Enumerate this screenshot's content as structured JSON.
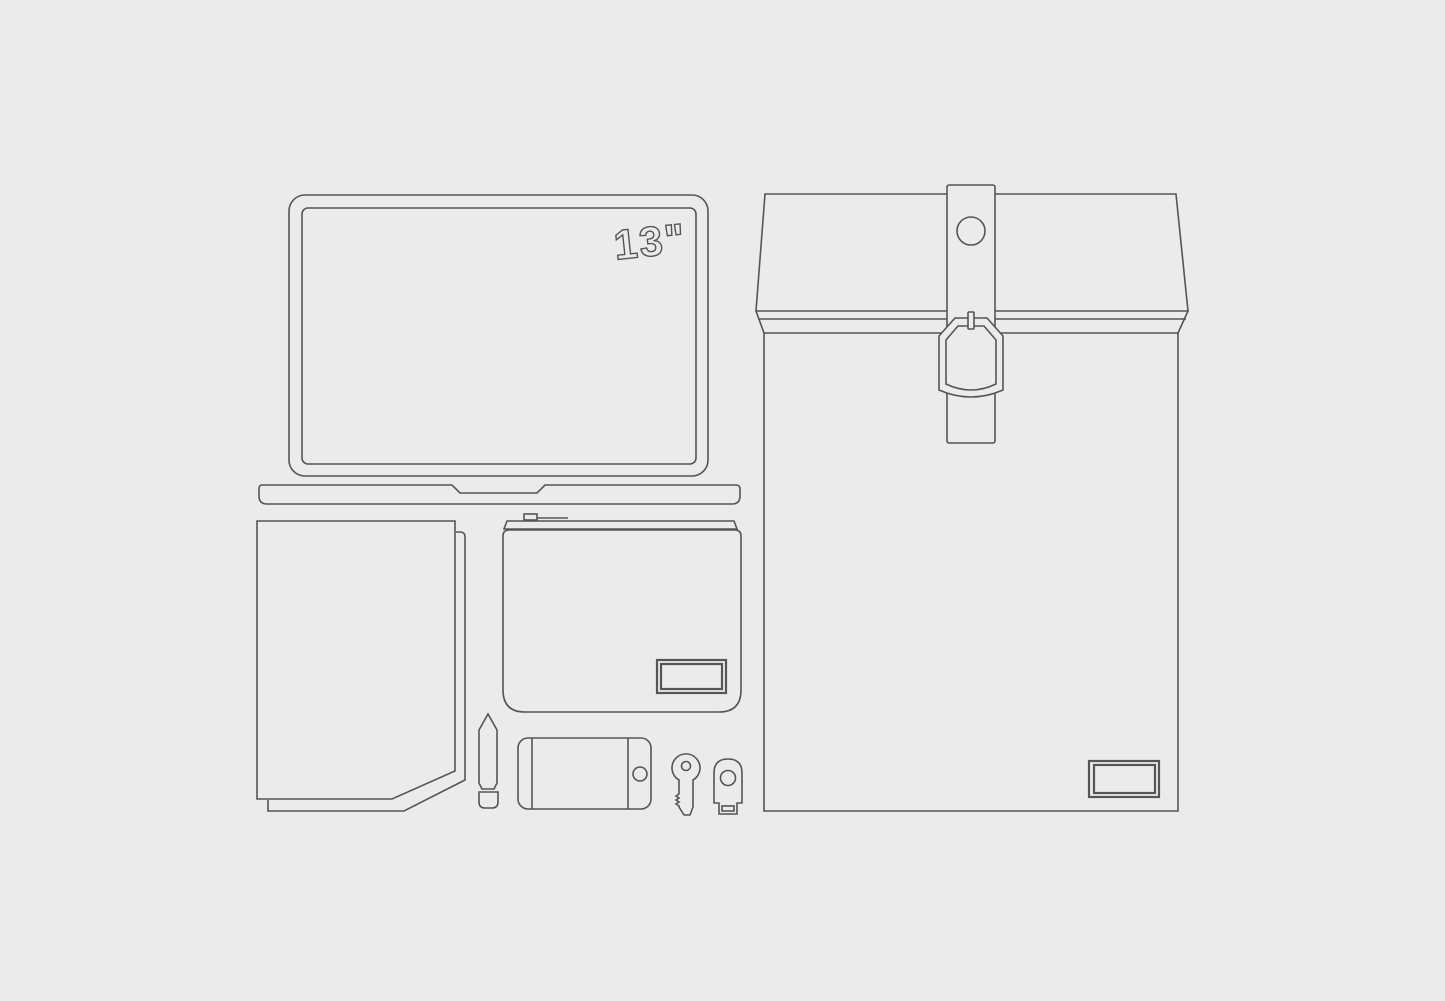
{
  "scene": {
    "title": "Tech gear outline flat-lay illustration",
    "background_color": "#ebebec",
    "line_color": "#545557",
    "laptop": {
      "size_label": "13\"",
      "name": "13-inch laptop"
    },
    "items": [
      {
        "name": "laptop",
        "label": "13\" laptop with base"
      },
      {
        "name": "sleeve-bag",
        "label": "Flap sleeve bag with strap, snap button, buckle and blank label patch"
      },
      {
        "name": "folder",
        "label": "Folder with clipped corner"
      },
      {
        "name": "zip-pouch",
        "label": "Zipper pouch with blank label patch"
      },
      {
        "name": "pencil",
        "label": "Pencil"
      },
      {
        "name": "smartphone",
        "label": "Smartphone (landscape) with home button"
      },
      {
        "name": "key",
        "label": "Key"
      },
      {
        "name": "usb-key",
        "label": "USB security key"
      }
    ]
  }
}
